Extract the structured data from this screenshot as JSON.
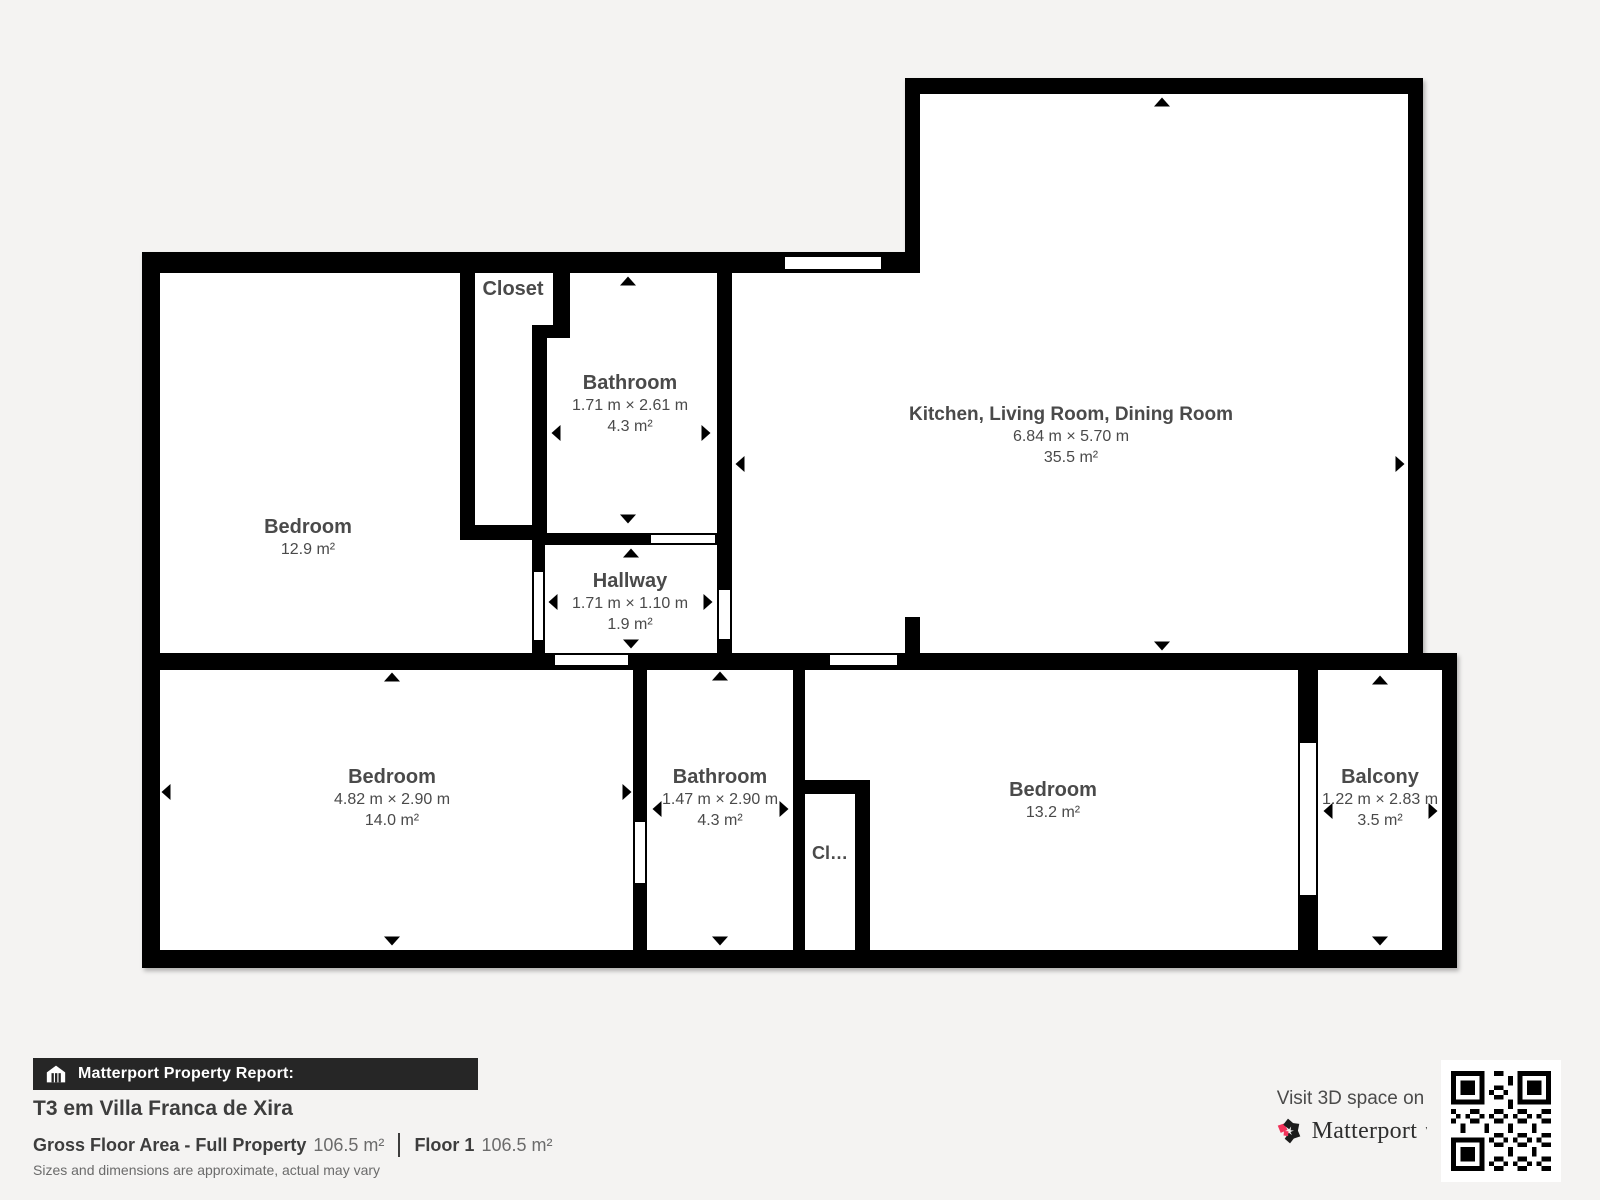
{
  "plan": {
    "rooms": [
      {
        "name": "Bedroom",
        "area": "12.9 m²"
      },
      {
        "name": "Closet"
      },
      {
        "name": "Bathroom",
        "dims": "1.71 m × 2.61 m",
        "area": "4.3 m²"
      },
      {
        "name": "Hallway",
        "dims": "1.71 m × 1.10 m",
        "area": "1.9 m²"
      },
      {
        "name": "Kitchen, Living Room, Dining Room",
        "dims": "6.84 m × 5.70 m",
        "area": "35.5 m²"
      },
      {
        "name": "Bedroom",
        "dims": "4.82 m × 2.90 m",
        "area": "14.0 m²"
      },
      {
        "name": "Bathroom",
        "dims": "1.47 m × 2.90 m",
        "area": "4.3 m²"
      },
      {
        "name": "Cl…"
      },
      {
        "name": "Bedroom",
        "area": "13.2 m²"
      },
      {
        "name": "Balcony",
        "dims": "1.22 m × 2.83 m",
        "area": "3.5 m²"
      }
    ]
  },
  "footer": {
    "report_label": "Matterport Property Report:",
    "property_title": "T3 em Villa Franca de Xira",
    "gross_label": "Gross Floor Area - Full Property",
    "gross_value": "106.5 m²",
    "floor_label": "Floor 1",
    "floor_value": "106.5 m²",
    "disclaimer": "Sizes and dimensions are approximate, actual may vary",
    "visit_text": "Visit 3D space on",
    "brand": "Matterport",
    "brand_mark": "’",
    "brand_accent_color": "#f1325a",
    "wall_color": "#000000",
    "background_color": "#f4f3f2"
  }
}
